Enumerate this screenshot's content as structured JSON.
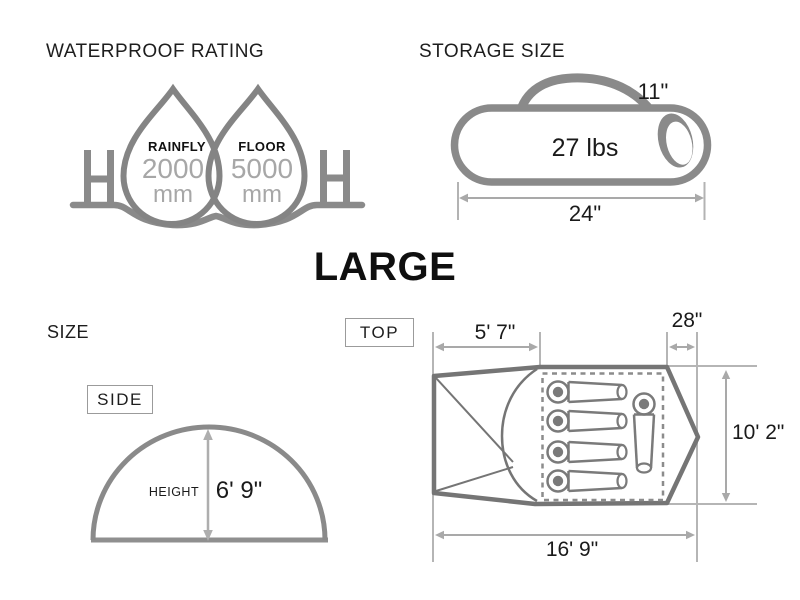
{
  "palette": {
    "icon_gray": "#8a8a8a",
    "tent_gray": "#757575",
    "dimension_gray": "#a9a9a9",
    "extension_gray": "#b5b5b5",
    "value_gray": "#a7a7a7",
    "text_black": "#1a1a1a"
  },
  "waterproof": {
    "title": "WATERPROOF RATING",
    "drops": [
      {
        "label": "RAINFLY",
        "value": "2000",
        "unit": "mm"
      },
      {
        "label": "FLOOR",
        "value": "5000",
        "unit": "mm"
      }
    ]
  },
  "storage": {
    "title": "STORAGE SIZE",
    "weight": "27 lbs",
    "diameter": "11\"",
    "length": "24\""
  },
  "size_name": "LARGE",
  "size": {
    "title": "SIZE",
    "side_view": {
      "label": "SIDE",
      "height_label": "HEIGHT",
      "height": "6' 9\""
    },
    "top_view": {
      "label": "TOP",
      "vestibule_depth": "5' 7\"",
      "rear_depth": "28\"",
      "width": "10' 2\"",
      "length": "16' 9\""
    }
  }
}
